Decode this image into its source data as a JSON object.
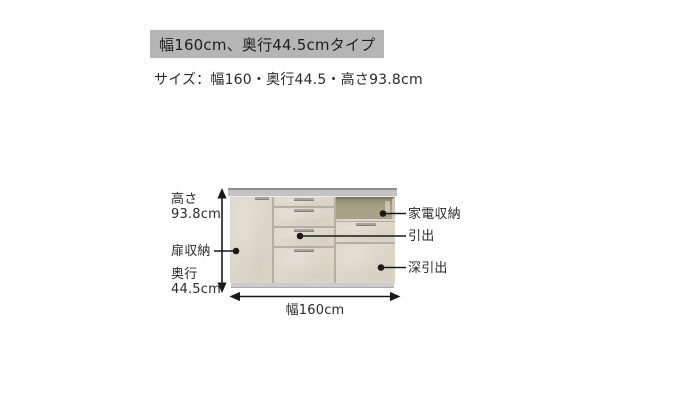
{
  "colors": {
    "page_bg": "#ffffff",
    "header_bg": "#b5b5b5",
    "text_dark": "#1f1f1f",
    "text_label": "#2b2b2b",
    "cabinet_body": "#ddd6c9",
    "cabinet_gap": "#b3afa7",
    "counter_face": "#c3c3c3",
    "counter_top_edge": "#8e8e8e",
    "base": "#cccccc",
    "base_edge": "#a9a9a9",
    "appliance_interior": "#a49e83",
    "appliance_shadow": "#7e7964",
    "appliance_side": "#cdc6b8",
    "handle": "#a8a39a",
    "dimension_line": "#1a1a1a"
  },
  "header": {
    "title": "幅160cm、奥行44.5cmタイプ",
    "subtitle": "サイズ：幅160・奥行44.5・高さ93.8cm"
  },
  "diagram": {
    "labels": {
      "height_line1": "高さ",
      "height_line2": "93.8cm",
      "door_storage": "扉収納",
      "depth_line1": "奥行",
      "depth_line2": "44.5cm",
      "appliance_storage": "家電収納",
      "drawer": "引出",
      "deep_drawer": "深引出",
      "width": "幅160cm"
    },
    "dimensions": {
      "width_cm": "160",
      "depth_cm": "44.5",
      "height_cm": "93.8"
    }
  }
}
